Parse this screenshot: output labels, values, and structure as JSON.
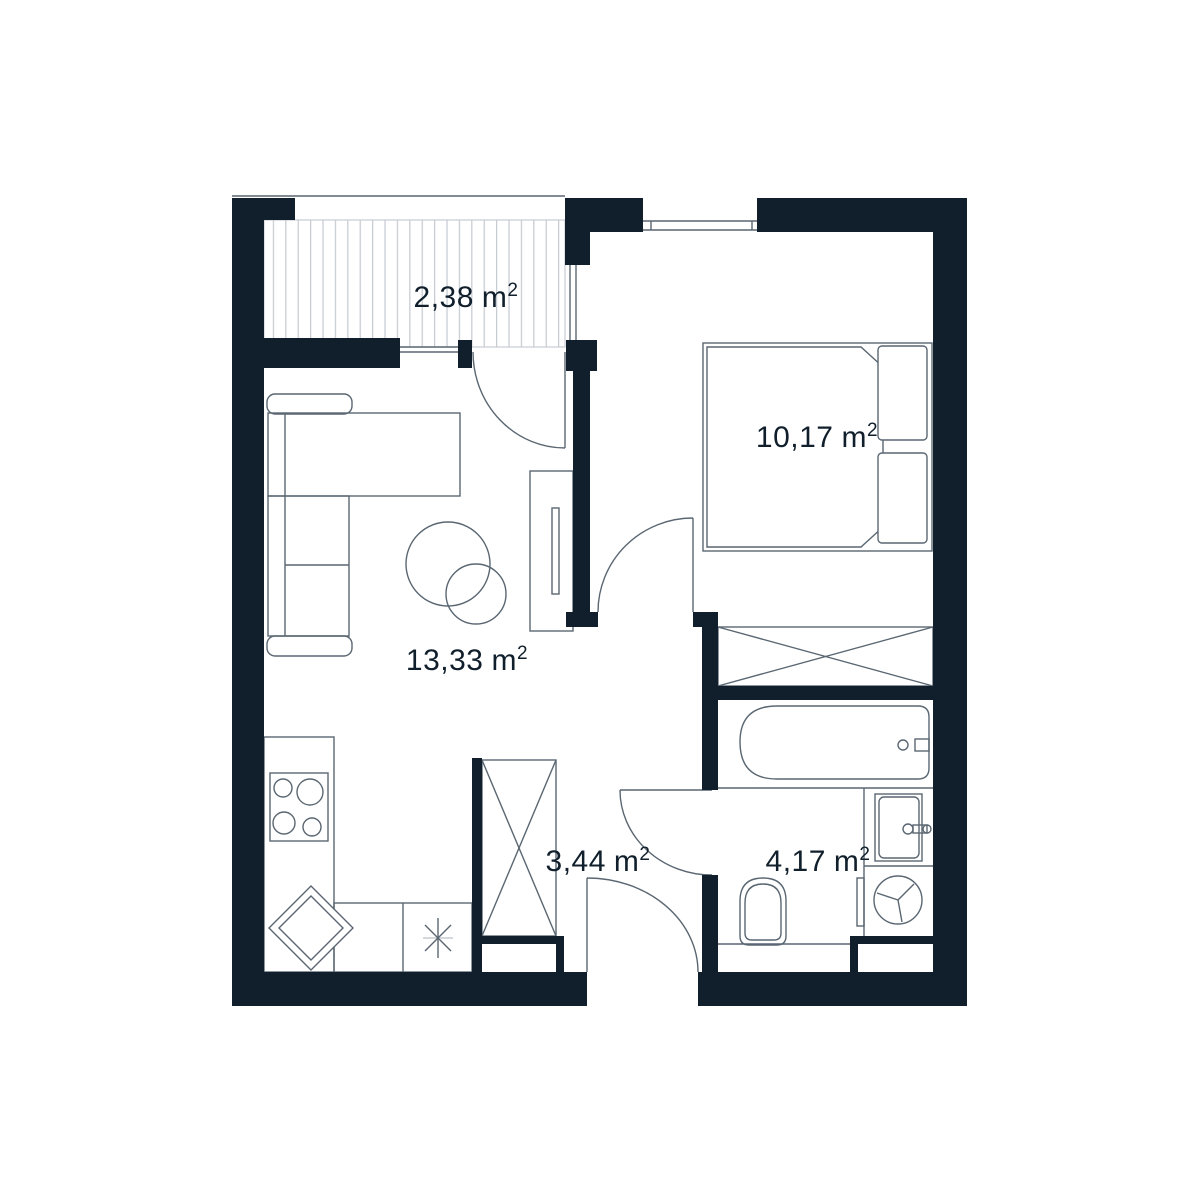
{
  "labels": {
    "balcony": {
      "area": "2,38"
    },
    "bedroom": {
      "area": "10,17"
    },
    "living_room": {
      "area": "13,33"
    },
    "hallway": {
      "area": "3,44"
    },
    "bathroom": {
      "area": "4,17"
    }
  },
  "units": {
    "unit": "m",
    "sup": "2"
  },
  "colors": {
    "wall": "#101f2b",
    "line": "#5a6772",
    "hatch": "#c6ccd2",
    "bg": "#ffffff",
    "text": "#101f2b"
  }
}
